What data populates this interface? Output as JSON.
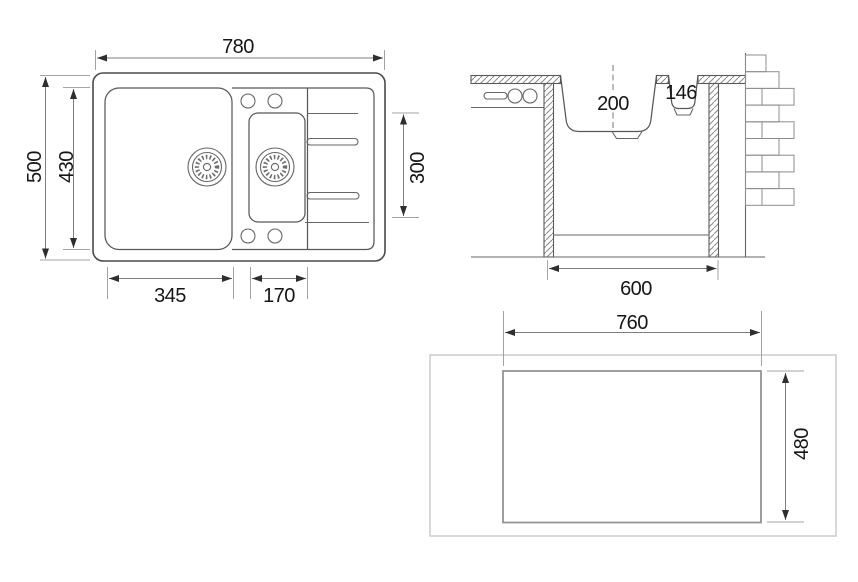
{
  "colors": {
    "ink": "#4a4a4a",
    "dimension_lines": "#7d7d7d",
    "label_text": "#161616",
    "background": "#ffffff"
  },
  "views": {
    "top": {
      "title": "sink-top-view",
      "dimensions": {
        "overall_width": "780",
        "overall_depth": "500",
        "inner_depth": "430",
        "main_bowl_width": "345",
        "small_bowl_width": "170",
        "small_bowl_length": "300"
      }
    },
    "section": {
      "title": "sink-section-view",
      "dimensions": {
        "main_bowl_depth": "200",
        "small_bowl_depth": "146",
        "cabinet_width": "600"
      }
    },
    "cutout": {
      "title": "worktop-cutout-view",
      "dimensions": {
        "cutout_width": "760",
        "cutout_depth": "480"
      }
    }
  }
}
